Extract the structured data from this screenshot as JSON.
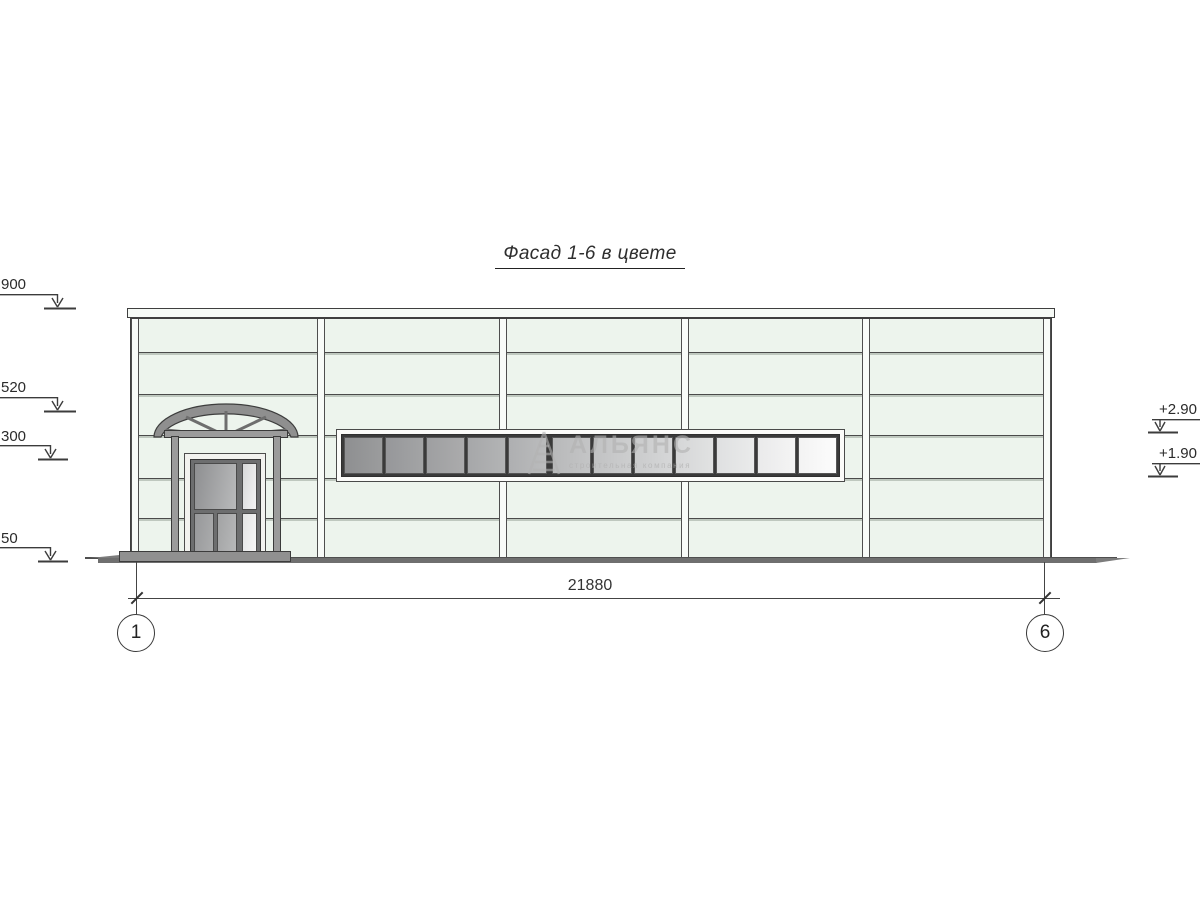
{
  "title": "Фасад 1-6 в цвете",
  "watermark": {
    "name": "АЛЬЯНС",
    "tagline": "строительная компания"
  },
  "dimension": {
    "total": "21880"
  },
  "axes": {
    "left": "1",
    "right": "6"
  },
  "elevations": {
    "left": [
      {
        "label": "900"
      },
      {
        "label": "520"
      },
      {
        "label": "300"
      },
      {
        "label": "50"
      }
    ],
    "right": [
      {
        "label": "+2.90"
      },
      {
        "label": "+1.90"
      }
    ]
  },
  "facade": {
    "wall_color": "#edf4ed",
    "pilaster_color": "#f8fbf8",
    "ground_color": "#6f6f6f",
    "outline_color": "#3f3f3f",
    "bays": 5,
    "window": {
      "panes": [
        {
          "from": "#8e8f91",
          "to": "#9b9c9d"
        },
        {
          "from": "#96979a",
          "to": "#a3a4a5"
        },
        {
          "from": "#9e9fa1",
          "to": "#ababac"
        },
        {
          "from": "#a6a7a9",
          "to": "#b3b4b5"
        },
        {
          "from": "#aeafb1",
          "to": "#bbbcbd"
        },
        {
          "from": "#b8b9ba",
          "to": "#c4c5c6"
        },
        {
          "from": "#c1c2c3",
          "to": "#cdcecf"
        },
        {
          "from": "#cacbcc",
          "to": "#d6d7d8"
        },
        {
          "from": "#d5d6d7",
          "to": "#e1e2e2"
        },
        {
          "from": "#dfe0e1",
          "to": "#eaebeb"
        },
        {
          "from": "#eaeaeb",
          "to": "#f4f4f4"
        },
        {
          "from": "#f3f3f3",
          "to": "#fcfcfc"
        }
      ]
    }
  }
}
